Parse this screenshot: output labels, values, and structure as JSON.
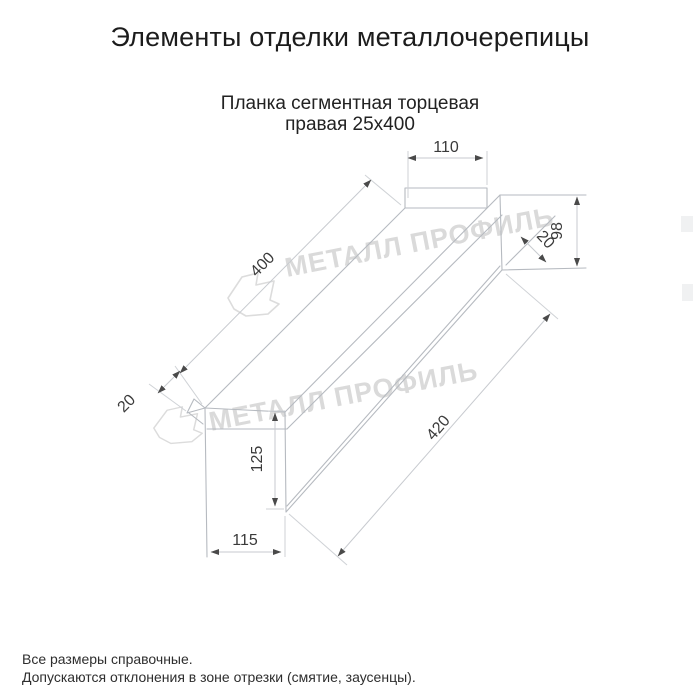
{
  "header": {
    "title": "Элементы отделки металлочерепицы",
    "subtitle_line1": "Планка сегментная торцевая",
    "subtitle_line2": "правая 25х400"
  },
  "drawing": {
    "type": "isometric technical drawing of right segmented end trim strip",
    "dimensions": {
      "top_flange_width": "110",
      "right_end_height": "98",
      "right_hem": "20",
      "top_length": "400",
      "left_hem": "20",
      "left_end_height": "125",
      "bottom_width": "115",
      "bottom_length": "420"
    },
    "watermark_text": "МЕТАЛЛ ПРОФИЛЬ"
  },
  "footer": {
    "note1": "Все размеры справочные.",
    "note2": "Допускаются отклонения в зоне отрезки (смятие, заусенцы)."
  },
  "colors": {
    "background": "#ffffff",
    "shape_lines": "#b6bac0",
    "dimension_lines": "#c7cacf",
    "dimension_text": "#3a3a3a",
    "watermark": "#dadada",
    "title_text": "#1c1c1c"
  }
}
